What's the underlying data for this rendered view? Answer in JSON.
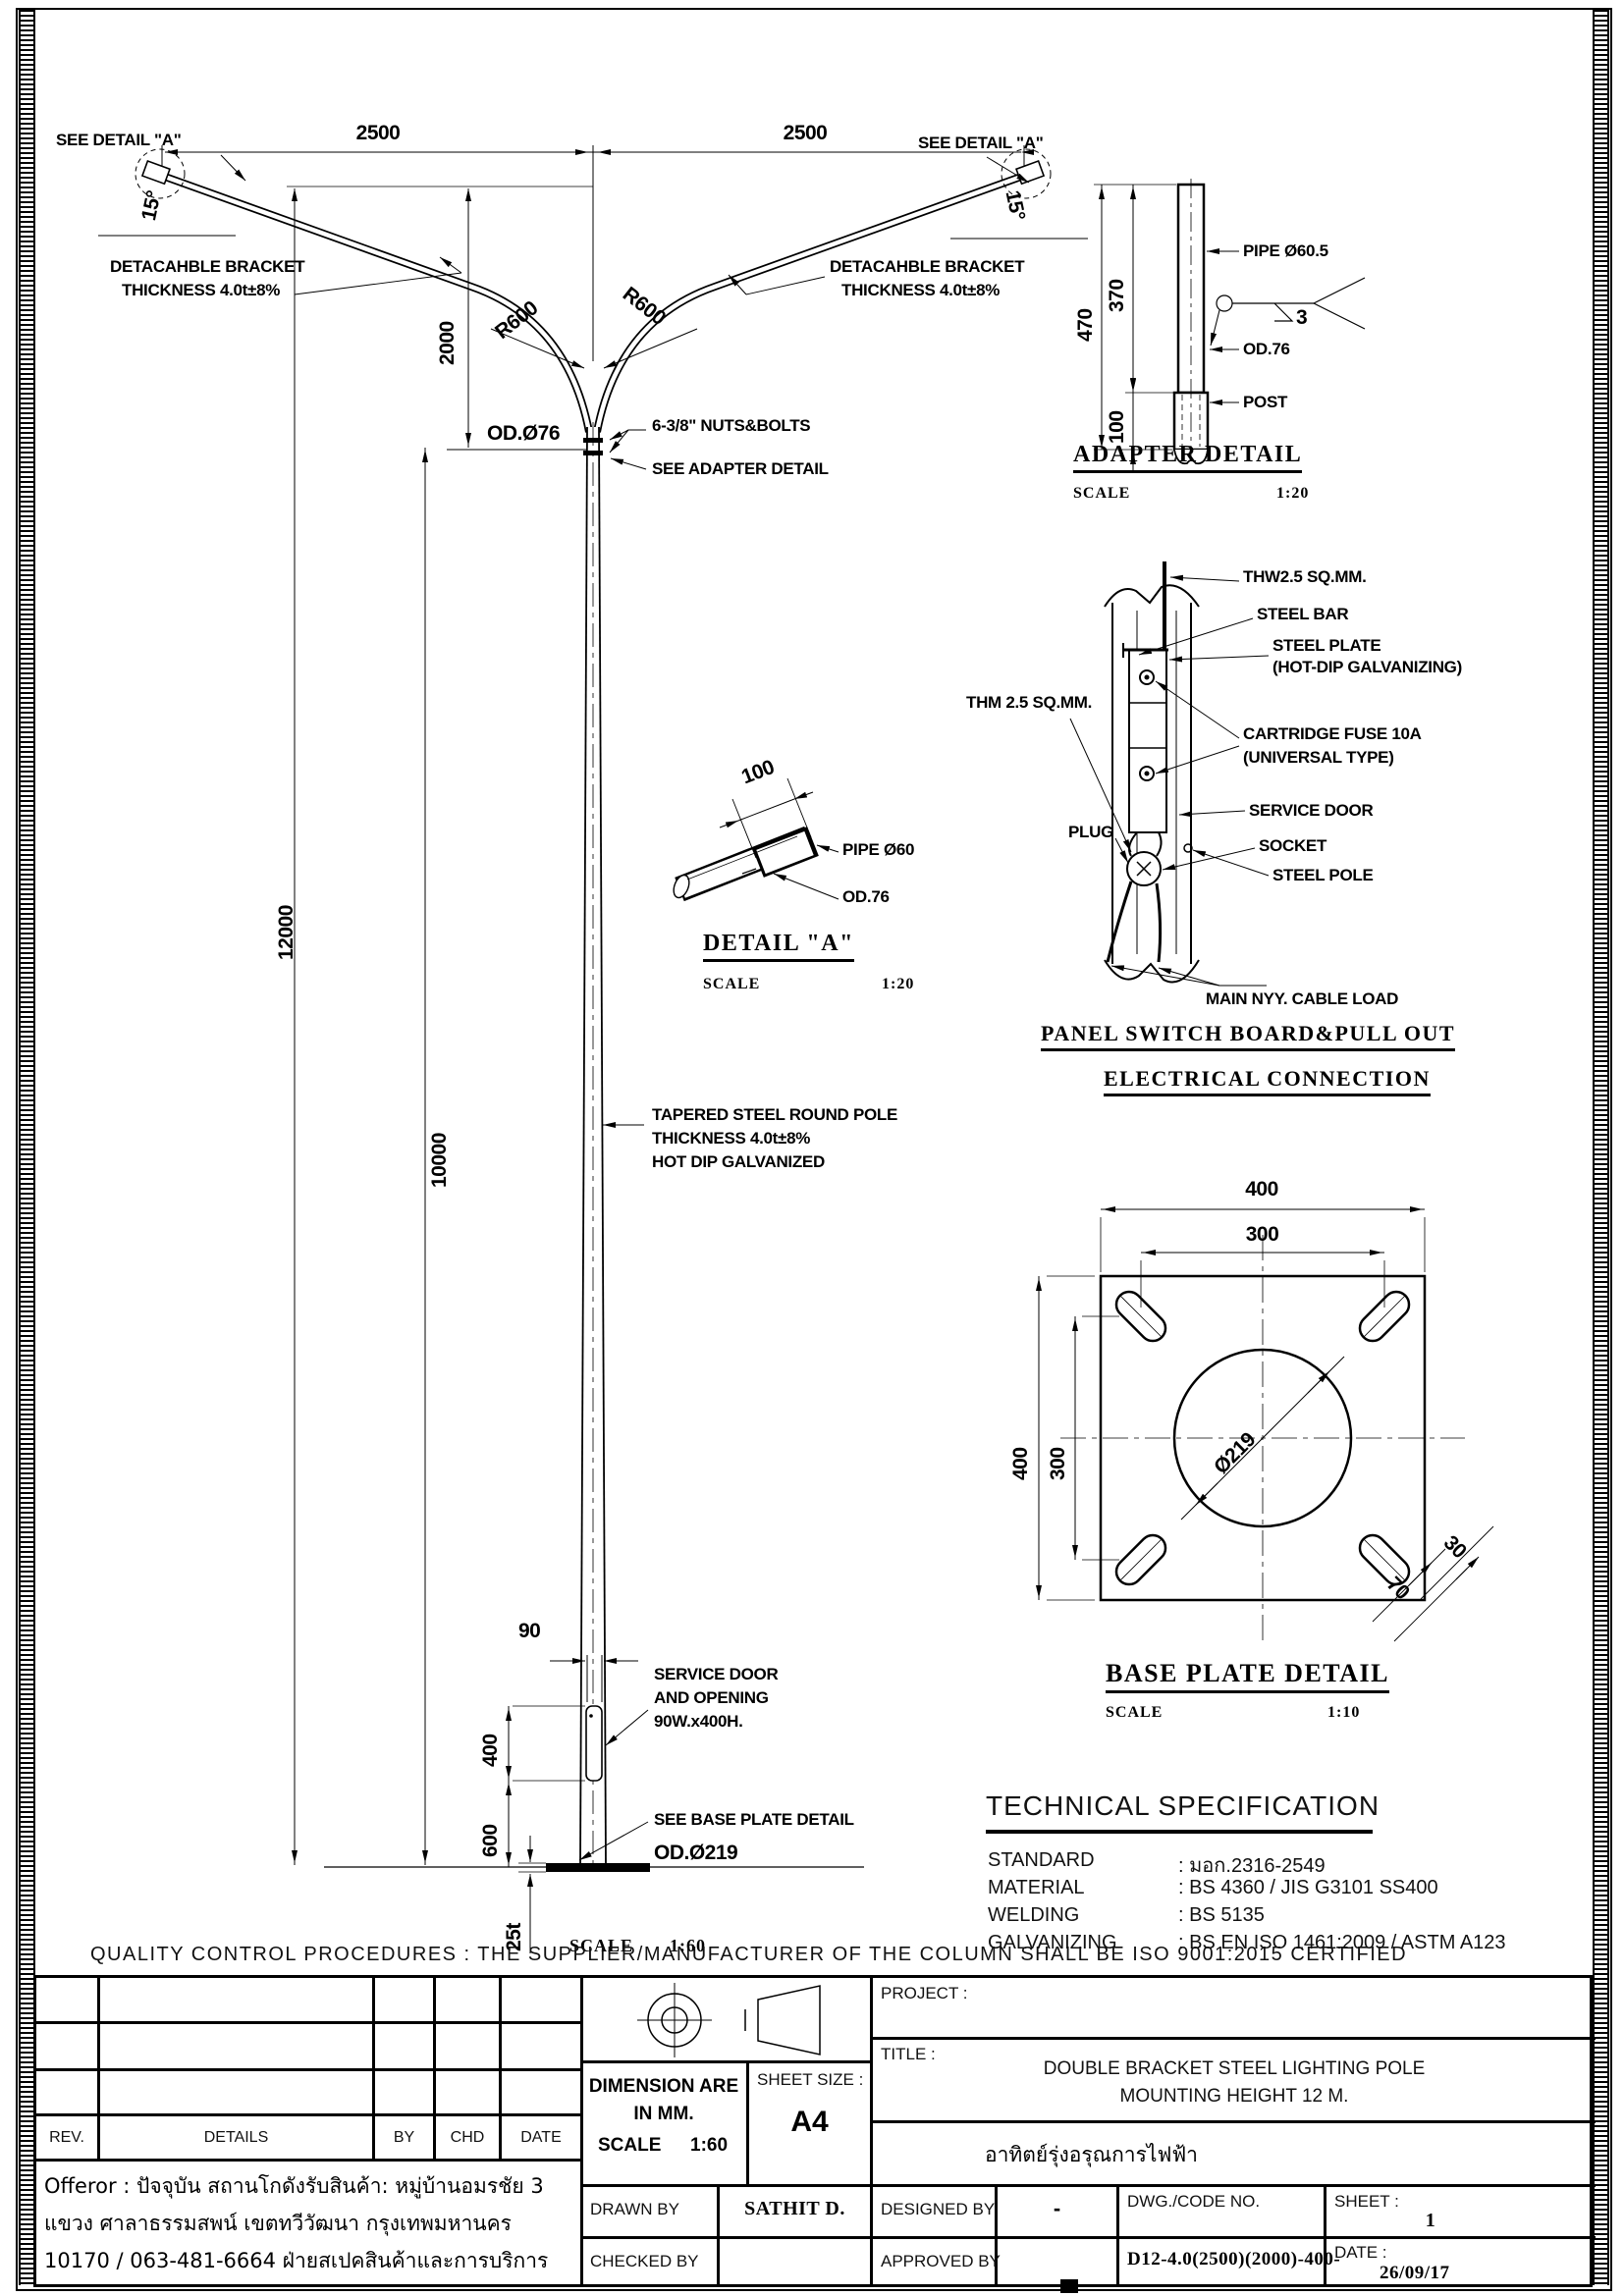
{
  "top_view": {
    "see_detail_left": "SEE DETAIL \"A\"",
    "see_detail_right": "SEE DETAIL \"A\"",
    "dim_left": "2500",
    "dim_right": "2500",
    "angle_left": "15°",
    "angle_right": "15°",
    "bracket_note_1": "DETACAHBLE BRACKET",
    "bracket_note_2": "THICKNESS 4.0t±8%",
    "r600": "R600",
    "dim_drop": "2000"
  },
  "pole": {
    "dim_total": "12000",
    "dim_lower": "10000",
    "od76": "OD.Ø76",
    "nuts": "6-3/8\" NUTS&BOLTS",
    "see_adapter": "SEE ADAPTER DETAIL",
    "tapered_1": "TAPERED STEEL ROUND POLE",
    "tapered_2": "THICKNESS 4.0t±8%",
    "tapered_3": "HOT DIP GALVANIZED",
    "dim_90": "90",
    "dim_400": "400",
    "dim_600": "600",
    "dim_25t": "25t",
    "service_1": "SERVICE DOOR",
    "service_2": "AND OPENING",
    "service_3": "90W.x400H.",
    "see_base": "SEE BASE PLATE DETAIL",
    "od219": "OD.Ø219",
    "scale_label": "SCALE",
    "scale_val": "1:60"
  },
  "adapter": {
    "dim_470": "470",
    "dim_370": "370",
    "dim_100": "100",
    "pipe": "PIPE Ø60.5",
    "weld_num": "3",
    "od76": "OD.76",
    "post": "POST",
    "title": "ADAPTER DETAIL",
    "scale_label": "SCALE",
    "scale_val": "1:20"
  },
  "detail_a": {
    "dim_100": "100",
    "pipe": "PIPE Ø60",
    "od76": "OD.76",
    "title": "DETAIL \"A\"",
    "scale_label": "SCALE",
    "scale_val": "1:20"
  },
  "panel": {
    "thw": "THW2.5 SQ.MM.",
    "steel_bar": "STEEL BAR",
    "steel_plate_1": "STEEL PLATE",
    "steel_plate_2": "(HOT-DIP GALVANIZING)",
    "thm": "THM 2.5 SQ.MM.",
    "fuse_1": "CARTRIDGE FUSE 10A",
    "fuse_2": "(UNIVERSAL TYPE)",
    "plug": "PLUG",
    "service_door": "SERVICE DOOR",
    "socket": "SOCKET",
    "steel_pole": "STEEL POLE",
    "main_cable": "MAIN NYY. CABLE LOAD",
    "title_1": "PANEL SWITCH BOARD&PULL OUT",
    "title_2": "ELECTRICAL CONNECTION"
  },
  "base_plate": {
    "dim_400_top": "400",
    "dim_300_top": "300",
    "dim_400_left": "400",
    "dim_300_left": "300",
    "dia": "Ø219",
    "dim_30": "30",
    "dim_70": "70",
    "title": "BASE PLATE DETAIL",
    "scale_label": "SCALE",
    "scale_val": "1:10"
  },
  "spec": {
    "title": "TECHNICAL SPECIFICATION",
    "rows": [
      {
        "label": "STANDARD",
        "value": ": มอก.2316-2549"
      },
      {
        "label": "MATERIAL",
        "value": ": BS 4360 / JIS G3101 SS400"
      },
      {
        "label": "WELDING",
        "value": ": BS 5135"
      },
      {
        "label": "GALVANIZING",
        "value": ": BS EN ISO 1461:2009 / ASTM A123"
      }
    ]
  },
  "quality_line": "QUALITY CONTROL PROCEDURES :    THE SUPPLIER/MANUFACTURER OF THE COLUMN SHALL BE ISO 9001:2015 CERTIFIED",
  "title_block": {
    "rev": "REV.",
    "details": "DETAILS",
    "by": "BY",
    "chd": "CHD",
    "date_col": "DATE",
    "address_1": "Offeror : ปัจจุบัน สถานโกดังรับสินค้า: หมู่บ้านอมรชัย 3",
    "address_2": "แขวง ศาลาธรรมสพน์ เขตทวีวัฒนา กรุงเทพมหานคร",
    "address_3": "10170 / 063-481-6664 ฝ่ายสเปคสินค้าและการบริการ",
    "dimension_1": "DIMENSION ARE",
    "dimension_2": "IN MM.",
    "scale_label": "SCALE",
    "scale_val": "1:60",
    "sheet_size_label": "SHEET SIZE :",
    "sheet_size": "A4",
    "drawn_by": "DRAWN BY",
    "drawn_val": "SATHIT D.",
    "checked_by": "CHECKED BY",
    "project_label": "PROJECT :",
    "title_label": "TITLE :",
    "title_1": "DOUBLE BRACKET STEEL LIGHTING POLE",
    "title_2": "MOUNTING HEIGHT 12 M.",
    "company_thai": "อาทิตย์รุ่งอรุณการไฟฟ้า",
    "designed_by": "DESIGNED BY",
    "designed_val": "-",
    "approved_by": "APPROVED BY",
    "dwg_label": "DWG./CODE NO.",
    "dwg_val": "D12-4.0(2500)(2000)-400-",
    "sheet_label": "SHEET :",
    "sheet_val": "1",
    "date_label": "DATE :",
    "date_val": "26/09/17"
  }
}
